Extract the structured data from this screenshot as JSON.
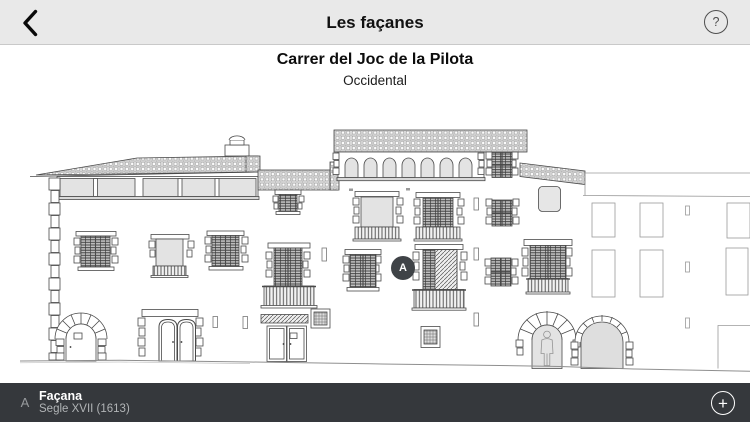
{
  "header": {
    "title": "Les façanes",
    "help_icon": "?"
  },
  "subheader": {
    "title": "Carrer del Joc de la Pilota",
    "subtitle": "Occidental"
  },
  "drawing": {
    "marker_a_label": "A"
  },
  "footer": {
    "marker_label": "A",
    "title": "Façana",
    "subtitle": "Segle XVII (1613)",
    "add_icon": "+"
  },
  "colors": {
    "header_bg": "#e9e9e9",
    "footer_bg": "#35383c",
    "marker_bg": "#3f4347",
    "line_color": "#4a4a4a",
    "fill_gray": "#e3e3e3"
  }
}
